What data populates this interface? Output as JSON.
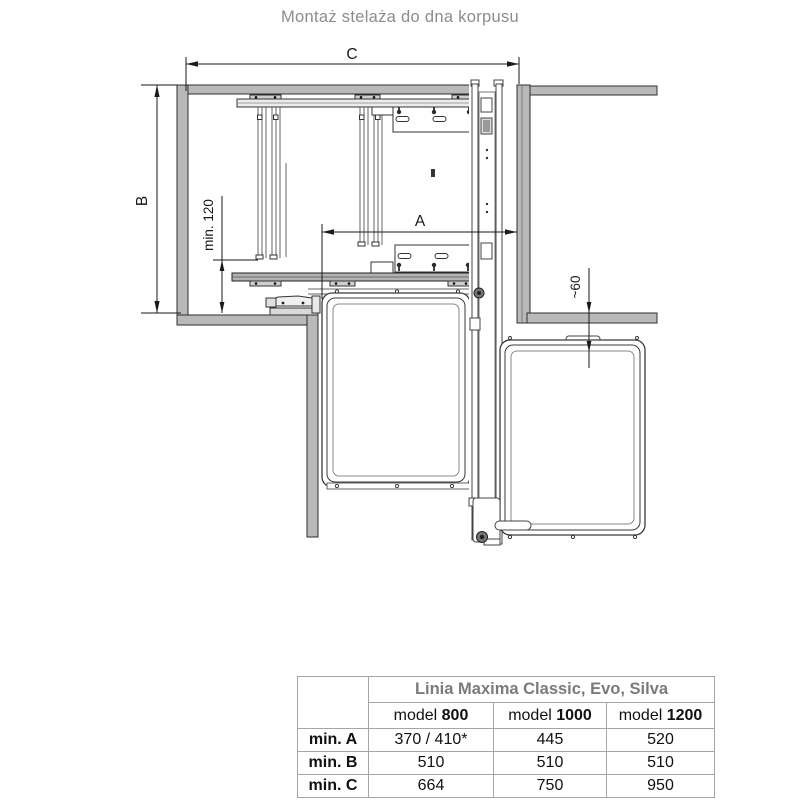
{
  "title": "Montaż stelaża do dna korpusu",
  "drawing": {
    "labels": {
      "c": "C",
      "b": "B",
      "a": "A",
      "min120": "min. 120",
      "approx60": "~60"
    }
  },
  "table": {
    "group_header": "Linia Maxima Classic, Evo, Silva",
    "models": [
      {
        "prefix": "model ",
        "number": "800"
      },
      {
        "prefix": "model ",
        "number": "1000"
      },
      {
        "prefix": "model ",
        "number": "1200"
      }
    ],
    "rows": [
      {
        "label": "min. A",
        "values": [
          "370 / 410*",
          "445",
          "520"
        ]
      },
      {
        "label": "min. B",
        "values": [
          "510",
          "510",
          "510"
        ]
      },
      {
        "label": "min. C",
        "values": [
          "664",
          "750",
          "950"
        ]
      }
    ]
  },
  "colors": {
    "wall_fill": "#b9b9b9",
    "line": "#2e2e2e",
    "title_text": "#8c8c8c",
    "table_border": "#a6a6a6",
    "table_header_text": "#7b7b7b"
  }
}
